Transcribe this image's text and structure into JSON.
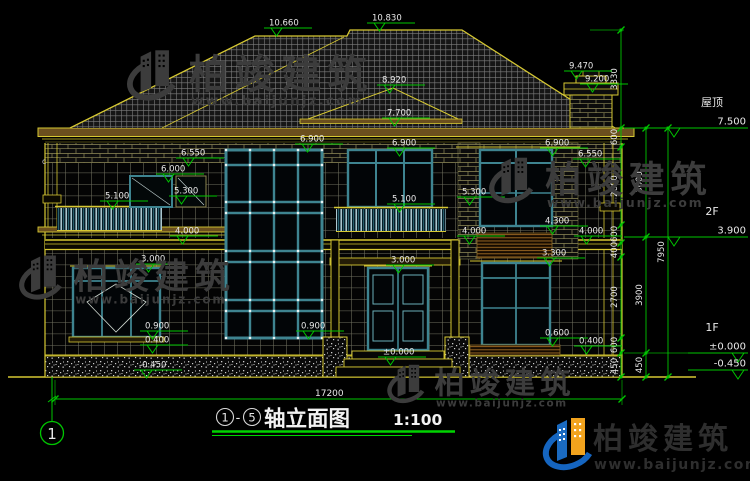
{
  "drawing": {
    "title": {
      "prefix_axis": "1",
      "suffix_axis": "5",
      "name": "轴立面图",
      "scale": "1:100",
      "separator": "-"
    },
    "axis_bubble": "1",
    "stray_mark": "c"
  },
  "brand": {
    "company": "柏竣建筑",
    "url": "www.baijunjz.com"
  },
  "right_levels": [
    {
      "name": "屋顶",
      "value": "7.500",
      "y": 128,
      "lx": 624
    },
    {
      "name": "2F",
      "value": "3.900",
      "y": 237,
      "lx": 624
    },
    {
      "name": "1F",
      "value": "±0.000",
      "y": 353,
      "lx": 688
    },
    {
      "name": "",
      "value": "-0.450",
      "y": 370,
      "lx": 688
    }
  ],
  "elevation_markers": [
    {
      "label": "10.660",
      "x": 266,
      "y": 28
    },
    {
      "label": "10.830",
      "x": 369,
      "y": 23
    },
    {
      "label": "9.470",
      "x": 566,
      "y": 71
    },
    {
      "label": "9.200",
      "x": 582,
      "y": 84
    },
    {
      "label": "8.920",
      "x": 379,
      "y": 85
    },
    {
      "label": "7.700",
      "x": 384,
      "y": 118
    },
    {
      "label": "6.900",
      "x": 297,
      "y": 144
    },
    {
      "label": "6.900",
      "x": 389,
      "y": 148
    },
    {
      "label": "6.900",
      "x": 542,
      "y": 148
    },
    {
      "label": "6.550",
      "x": 178,
      "y": 158
    },
    {
      "label": "6.550",
      "x": 575,
      "y": 159
    },
    {
      "label": "6.000",
      "x": 158,
      "y": 174
    },
    {
      "label": "5.300",
      "x": 171,
      "y": 196
    },
    {
      "label": "5.300",
      "x": 459,
      "y": 197
    },
    {
      "label": "5.100",
      "x": 102,
      "y": 201
    },
    {
      "label": "5.100",
      "x": 389,
      "y": 204
    },
    {
      "label": "4.300",
      "x": 542,
      "y": 226
    },
    {
      "label": "4.000",
      "x": 172,
      "y": 236
    },
    {
      "label": "4.000",
      "x": 459,
      "y": 236
    },
    {
      "label": "4.000",
      "x": 576,
      "y": 236
    },
    {
      "label": "3.300",
      "x": 539,
      "y": 258
    },
    {
      "label": "3.000",
      "x": 138,
      "y": 264
    },
    {
      "label": "3.000",
      "x": 388,
      "y": 265
    },
    {
      "label": "0.900",
      "x": 142,
      "y": 331
    },
    {
      "label": "0.900",
      "x": 298,
      "y": 331
    },
    {
      "label": "0.600",
      "x": 542,
      "y": 338
    },
    {
      "label": "0.400",
      "x": 142,
      "y": 345
    },
    {
      "label": "0.400",
      "x": 576,
      "y": 346
    },
    {
      "label": "±0.000",
      "x": 380,
      "y": 357
    },
    {
      "label": "-0.450",
      "x": 136,
      "y": 370
    }
  ],
  "dim_chains": [
    {
      "x": 621,
      "ticks": [
        30,
        128,
        147,
        225,
        243,
        257,
        338,
        353,
        377
      ],
      "labels": [
        [
          "3330",
          79
        ],
        [
          "600",
          137
        ],
        [
          "2600",
          186
        ],
        [
          "600",
          234
        ],
        [
          "400",
          250
        ],
        [
          "2700",
          297
        ],
        [
          "600",
          345
        ],
        [
          "450",
          366
        ]
      ]
    },
    {
      "x": 646,
      "ticks": [
        128,
        237,
        353,
        377
      ],
      "labels": [
        [
          "3600",
          182
        ],
        [
          "3900",
          295
        ],
        [
          "450",
          365
        ]
      ]
    },
    {
      "x": 668,
      "ticks": [
        128,
        377
      ],
      "labels": [
        [
          "7950",
          252
        ]
      ]
    }
  ],
  "bottom_dim": {
    "label": "17200",
    "x1": 55,
    "x2": 622,
    "y": 399,
    "label_x": 315
  },
  "watermarks": [
    {
      "x": 128,
      "y": 44,
      "s": 1.05
    },
    {
      "x": 490,
      "y": 152,
      "s": 0.95
    },
    {
      "x": 20,
      "y": 250,
      "s": 0.92
    },
    {
      "x": 388,
      "y": 360,
      "s": 0.8
    }
  ],
  "colors": {
    "line": "#d6c832",
    "eave_fill": "#6b4f1e",
    "dim": "#00c600",
    "frame": "#3e8490",
    "frame_hi": "#79bcc4",
    "text": "#e8e8e8",
    "watermark": "#3c3c3c",
    "logo_blue": "#1565c0",
    "logo_orange": "#f2a31d",
    "title_green": "#00d400"
  }
}
